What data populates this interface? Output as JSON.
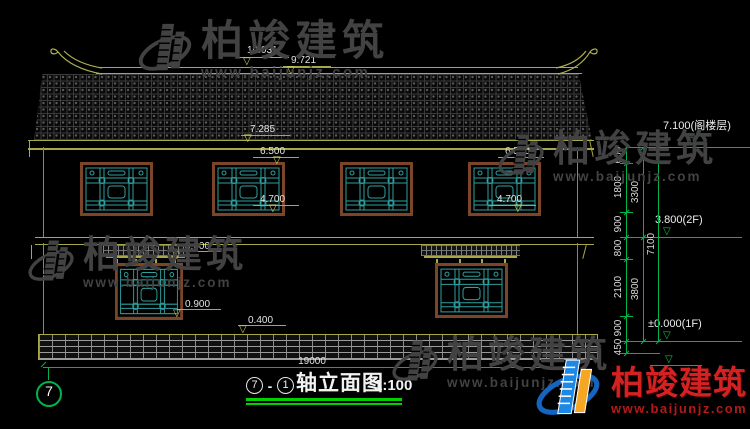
{
  "watermark": {
    "brand": "柏竣建筑",
    "url": "www.baijunjz.com",
    "color": "#424242"
  },
  "logo": {
    "brand": "柏竣建筑",
    "url": "www.baijunjz.com",
    "brand_color": "#d42222"
  },
  "title": {
    "axis_start": "7",
    "separator": "-",
    "axis_end": "1",
    "name": "轴立面图",
    "scale": "1:100"
  },
  "axis": {
    "bubble_left": "7"
  },
  "dims": {
    "total_width": "19000",
    "levels": {
      "ridge_top": "10.031",
      "roof_top": "9.721",
      "eave": "7.285",
      "attic": "7.100(阁楼层)",
      "floor2": "3.800(2F)",
      "floor1": "±0.000(1F)"
    },
    "openings": {
      "lintel_2f": "6.500",
      "sill_2f": "4.700",
      "lintel_1f": "3.000",
      "sill_1f": "0.900",
      "plinth_top": "0.400"
    },
    "right_chain_inner": [
      "600",
      "1800",
      "900",
      "800",
      "2100",
      "900",
      "450"
    ],
    "right_chain_mid": [
      "3300",
      "3800"
    ],
    "right_chain_outer": [
      "7100"
    ]
  },
  "colors": {
    "accent_green": "#00b34d",
    "line_yellow": "#a8a848",
    "lattice_teal": "#2fa0a0",
    "frame_brown": "#7a4528",
    "watermark_gray": "#424242",
    "logo_red": "#d42222",
    "logo_blue": "#1565c0",
    "logo_orange": "#f5a623"
  }
}
